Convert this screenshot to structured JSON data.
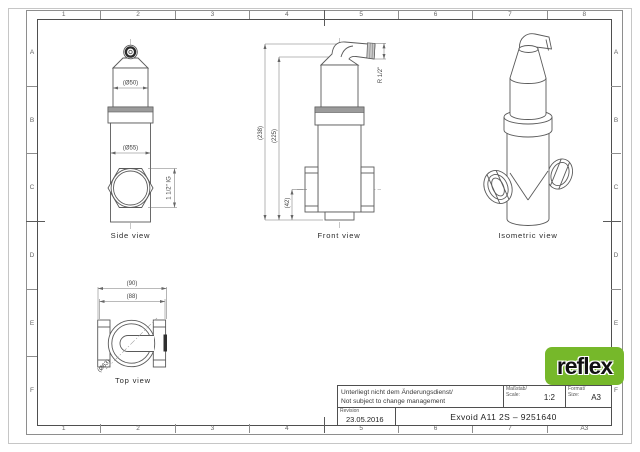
{
  "sheet": {
    "columns": [
      "1",
      "2",
      "3",
      "4",
      "5",
      "6",
      "7",
      "8"
    ],
    "bottom_columns": [
      "1",
      "2",
      "3",
      "4",
      "5",
      "6",
      "7",
      "A3"
    ],
    "rows": [
      "A",
      "B",
      "C",
      "D",
      "E",
      "F"
    ]
  },
  "title_block": {
    "note_line1": "Unterliegt nicht dem Änderungsdienst/",
    "note_line2": "Not subject to change management",
    "scale_label_de": "Maßstab/",
    "scale_label_en": "Scale:",
    "scale_value": "1:2",
    "format_label_de": "Format/",
    "format_label_en": "Size:",
    "format_value": "A3",
    "revision_label": "Revision",
    "revision_date": "23.05.2016",
    "drawing_title": "Exvoid A11 2S – 9251640"
  },
  "logo": {
    "text": "reflex",
    "color": "#76b82a"
  },
  "views": {
    "side": {
      "caption": "Side view",
      "dim_d50": "(Ø50)",
      "dim_d55": "(Ø55)",
      "dim_thread": "1 1/2\" IG"
    },
    "front": {
      "caption": "Front view",
      "dim_h238": "(238)",
      "dim_h225": "(225)",
      "dim_42": "(42)",
      "dim_r12": "R 1/2\""
    },
    "top": {
      "caption": "Top view",
      "dim_90": "(90)",
      "dim_88": "(88)",
      "dim_d63": "(Ø63)"
    },
    "iso": {
      "caption": "Isometric view"
    }
  }
}
